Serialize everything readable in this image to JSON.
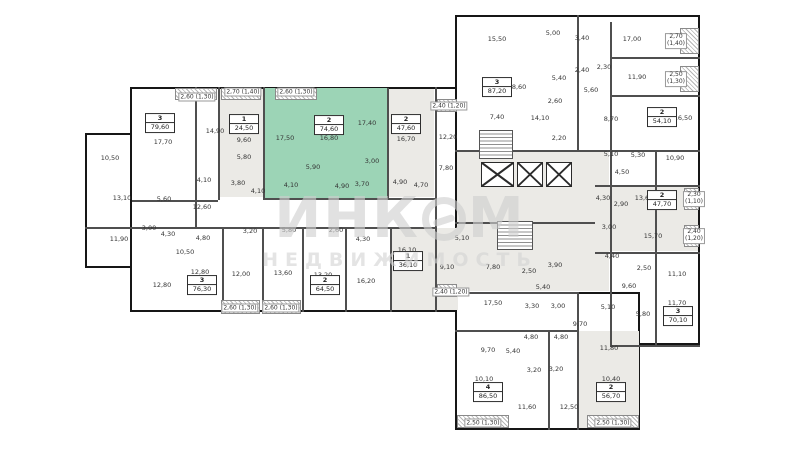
{
  "watermark": {
    "part1": "ИНК",
    "part2": "М",
    "subtitle": "НЕДВИЖИМОСТЬ"
  },
  "palette": {
    "wall": "#161616",
    "partition": "#4f4f4f",
    "unit_gray": "#ebeae6",
    "highlight_green": "#9cd4b6",
    "label_color": "#343434",
    "watermark_gray": "#d0d0d0"
  },
  "plan": {
    "outer": [
      {
        "x": 85,
        "y": 133,
        "w": 47,
        "h": 135
      },
      {
        "x": 130,
        "y": 87,
        "w": 330,
        "h": 225
      },
      {
        "x": 455,
        "y": 15,
        "w": 245,
        "h": 330
      },
      {
        "x": 455,
        "y": 292,
        "w": 185,
        "h": 138
      }
    ],
    "fills": [
      {
        "x": 219,
        "y": 89,
        "w": 44,
        "h": 108,
        "c": "#ebeae6"
      },
      {
        "x": 388,
        "y": 89,
        "w": 46,
        "h": 108,
        "c": "#ebeae6"
      },
      {
        "x": 390,
        "y": 228,
        "w": 68,
        "h": 82,
        "c": "#ebeae6"
      },
      {
        "x": 457,
        "y": 151,
        "w": 152,
        "h": 140,
        "c": "#ebeae6"
      },
      {
        "x": 596,
        "y": 186,
        "w": 102,
        "h": 65,
        "c": "#ebeae6"
      },
      {
        "x": 578,
        "y": 331,
        "w": 61,
        "h": 97,
        "c": "#ebeae6"
      },
      {
        "x": 263,
        "y": 88,
        "w": 124,
        "h": 110,
        "c": "#9cd4b6",
        "highlight": true
      }
    ],
    "walls_v": [
      {
        "x": 195,
        "y": 87,
        "len": 140
      },
      {
        "x": 218,
        "y": 87,
        "len": 113
      },
      {
        "x": 263,
        "y": 87,
        "len": 111
      },
      {
        "x": 387,
        "y": 88,
        "len": 110
      },
      {
        "x": 435,
        "y": 87,
        "len": 225
      },
      {
        "x": 222,
        "y": 227,
        "len": 85
      },
      {
        "x": 262,
        "y": 227,
        "len": 85
      },
      {
        "x": 302,
        "y": 227,
        "len": 85
      },
      {
        "x": 345,
        "y": 227,
        "len": 85
      },
      {
        "x": 390,
        "y": 227,
        "len": 85
      },
      {
        "x": 577,
        "y": 15,
        "len": 135
      },
      {
        "x": 610,
        "y": 22,
        "len": 323
      },
      {
        "x": 655,
        "y": 150,
        "len": 195
      },
      {
        "x": 577,
        "y": 292,
        "len": 138
      },
      {
        "x": 548,
        "y": 330,
        "len": 100
      }
    ],
    "walls_h": [
      {
        "y": 198,
        "x": 263,
        "len": 172
      },
      {
        "y": 227,
        "x": 85,
        "len": 350
      },
      {
        "y": 200,
        "x": 132,
        "len": 86
      },
      {
        "y": 150,
        "x": 455,
        "len": 245
      },
      {
        "y": 95,
        "x": 610,
        "len": 90
      },
      {
        "y": 57,
        "x": 610,
        "len": 90
      },
      {
        "y": 185,
        "x": 595,
        "len": 105
      },
      {
        "y": 252,
        "x": 595,
        "len": 105
      },
      {
        "y": 222,
        "x": 455,
        "len": 140
      },
      {
        "y": 292,
        "x": 437,
        "len": 140
      },
      {
        "y": 345,
        "x": 610,
        "len": 90
      },
      {
        "y": 330,
        "x": 455,
        "len": 122
      }
    ],
    "hatches": [
      {
        "x": 175,
        "y": 88,
        "w": 42,
        "h": 12
      },
      {
        "x": 221,
        "y": 88,
        "w": 40,
        "h": 12
      },
      {
        "x": 275,
        "y": 88,
        "w": 42,
        "h": 12
      },
      {
        "x": 437,
        "y": 99,
        "w": 20,
        "h": 13
      },
      {
        "x": 221,
        "y": 300,
        "w": 39,
        "h": 14
      },
      {
        "x": 262,
        "y": 300,
        "w": 39,
        "h": 14
      },
      {
        "x": 437,
        "y": 284,
        "w": 20,
        "h": 13
      },
      {
        "x": 457,
        "y": 415,
        "w": 52,
        "h": 13
      },
      {
        "x": 587,
        "y": 415,
        "w": 52,
        "h": 13
      },
      {
        "x": 680,
        "y": 28,
        "w": 19,
        "h": 26
      },
      {
        "x": 680,
        "y": 66,
        "w": 19,
        "h": 26
      },
      {
        "x": 684,
        "y": 188,
        "w": 15,
        "h": 22
      },
      {
        "x": 684,
        "y": 225,
        "w": 15,
        "h": 22
      }
    ],
    "shafts": [
      {
        "x": 481,
        "y": 162,
        "w": 33,
        "h": 25
      },
      {
        "x": 517,
        "y": 162,
        "w": 26,
        "h": 25
      },
      {
        "x": 546,
        "y": 162,
        "w": 26,
        "h": 25
      }
    ],
    "stairs": [
      {
        "x": 479,
        "y": 130,
        "w": 34,
        "h": 29
      },
      {
        "x": 497,
        "y": 221,
        "w": 36,
        "h": 29
      }
    ],
    "badges": [
      {
        "num": "3",
        "area": "79,60",
        "x": 160,
        "y": 123
      },
      {
        "num": "1",
        "area": "24,50",
        "x": 244,
        "y": 124
      },
      {
        "num": "2",
        "area": "74,60",
        "x": 329,
        "y": 125,
        "hl": true
      },
      {
        "num": "2",
        "area": "47,60",
        "x": 406,
        "y": 124
      },
      {
        "num": "3",
        "area": "87,20",
        "x": 497,
        "y": 87
      },
      {
        "num": "2",
        "area": "54,10",
        "x": 662,
        "y": 117
      },
      {
        "num": "2",
        "area": "47,70",
        "x": 662,
        "y": 200
      },
      {
        "num": "3",
        "area": "70,10",
        "x": 678,
        "y": 316
      },
      {
        "num": "2",
        "area": "56,70",
        "x": 611,
        "y": 392
      },
      {
        "num": "4",
        "area": "86,50",
        "x": 488,
        "y": 392
      },
      {
        "num": "3",
        "area": "76,30",
        "x": 202,
        "y": 285
      },
      {
        "num": "2",
        "area": "64,50",
        "x": 325,
        "y": 285
      },
      {
        "num": "1",
        "area": "36,10",
        "x": 408,
        "y": 261
      }
    ],
    "room_labels": [
      {
        "t": "10,50",
        "x": 110,
        "y": 158
      },
      {
        "t": "13,10",
        "x": 122,
        "y": 198
      },
      {
        "t": "17,70",
        "x": 163,
        "y": 142
      },
      {
        "t": "14,90",
        "x": 215,
        "y": 131
      },
      {
        "t": "5,60",
        "x": 164,
        "y": 199
      },
      {
        "t": "4,10",
        "x": 204,
        "y": 180
      },
      {
        "t": "12,60",
        "x": 202,
        "y": 207
      },
      {
        "t": "11,90",
        "x": 119,
        "y": 239
      },
      {
        "t": "3,00",
        "x": 149,
        "y": 228
      },
      {
        "t": "4,30",
        "x": 168,
        "y": 234
      },
      {
        "t": "4,80",
        "x": 203,
        "y": 238
      },
      {
        "t": "9,60",
        "x": 244,
        "y": 140
      },
      {
        "t": "5,80",
        "x": 244,
        "y": 157
      },
      {
        "t": "3,80",
        "x": 238,
        "y": 183
      },
      {
        "t": "4,10",
        "x": 258,
        "y": 191
      },
      {
        "t": "17,50",
        "x": 285,
        "y": 138
      },
      {
        "t": "16,80",
        "x": 329,
        "y": 138
      },
      {
        "t": "17,40",
        "x": 367,
        "y": 123
      },
      {
        "t": "5,90",
        "x": 313,
        "y": 167
      },
      {
        "t": "3,00",
        "x": 372,
        "y": 161
      },
      {
        "t": "4,10",
        "x": 291,
        "y": 185
      },
      {
        "t": "4,90",
        "x": 342,
        "y": 186
      },
      {
        "t": "3,70",
        "x": 362,
        "y": 184
      },
      {
        "t": "16,70",
        "x": 406,
        "y": 139
      },
      {
        "t": "4,90",
        "x": 400,
        "y": 182
      },
      {
        "t": "4,70",
        "x": 421,
        "y": 185
      },
      {
        "t": "10,50",
        "x": 185,
        "y": 252
      },
      {
        "t": "3,20",
        "x": 250,
        "y": 231
      },
      {
        "t": "5,80",
        "x": 289,
        "y": 230
      },
      {
        "t": "2,60",
        "x": 336,
        "y": 230
      },
      {
        "t": "4,30",
        "x": 363,
        "y": 239
      },
      {
        "t": "12,80",
        "x": 162,
        "y": 285
      },
      {
        "t": "12,80",
        "x": 200,
        "y": 272
      },
      {
        "t": "12,00",
        "x": 241,
        "y": 274
      },
      {
        "t": "13,60",
        "x": 283,
        "y": 273
      },
      {
        "t": "13,20",
        "x": 323,
        "y": 275
      },
      {
        "t": "16,20",
        "x": 366,
        "y": 281
      },
      {
        "t": "16,10",
        "x": 407,
        "y": 250
      },
      {
        "t": "9,10",
        "x": 447,
        "y": 267
      },
      {
        "t": "5,10",
        "x": 462,
        "y": 238
      },
      {
        "t": "12,20",
        "x": 448,
        "y": 137
      },
      {
        "t": "7,80",
        "x": 446,
        "y": 168
      },
      {
        "t": "7,80",
        "x": 493,
        "y": 267
      },
      {
        "t": "2,50",
        "x": 529,
        "y": 271
      },
      {
        "t": "3,90",
        "x": 555,
        "y": 265
      },
      {
        "t": "5,40",
        "x": 543,
        "y": 287
      },
      {
        "t": "2,20",
        "x": 559,
        "y": 138
      },
      {
        "t": "15,50",
        "x": 497,
        "y": 39
      },
      {
        "t": "5,00",
        "x": 553,
        "y": 33
      },
      {
        "t": "3,40",
        "x": 582,
        "y": 38
      },
      {
        "t": "18,60",
        "x": 517,
        "y": 87
      },
      {
        "t": "2,40",
        "x": 582,
        "y": 70
      },
      {
        "t": "2,30",
        "x": 604,
        "y": 67
      },
      {
        "t": "5,40",
        "x": 559,
        "y": 78
      },
      {
        "t": "5,60",
        "x": 591,
        "y": 90
      },
      {
        "t": "2,60",
        "x": 555,
        "y": 101
      },
      {
        "t": "7,40",
        "x": 497,
        "y": 117
      },
      {
        "t": "14,10",
        "x": 540,
        "y": 118
      },
      {
        "t": "17,00",
        "x": 632,
        "y": 39
      },
      {
        "t": "11,90",
        "x": 637,
        "y": 77
      },
      {
        "t": "8,70",
        "x": 611,
        "y": 119
      },
      {
        "t": "16,50",
        "x": 683,
        "y": 118
      },
      {
        "t": "5,10",
        "x": 611,
        "y": 154
      },
      {
        "t": "5,30",
        "x": 638,
        "y": 155
      },
      {
        "t": "10,90",
        "x": 675,
        "y": 158
      },
      {
        "t": "4,50",
        "x": 622,
        "y": 172
      },
      {
        "t": "4,30",
        "x": 603,
        "y": 198
      },
      {
        "t": "2,90",
        "x": 621,
        "y": 204
      },
      {
        "t": "13,60",
        "x": 644,
        "y": 198
      },
      {
        "t": "3,00",
        "x": 609,
        "y": 227
      },
      {
        "t": "15,70",
        "x": 653,
        "y": 236
      },
      {
        "t": "4,40",
        "x": 612,
        "y": 256
      },
      {
        "t": "2,50",
        "x": 644,
        "y": 268
      },
      {
        "t": "11,10",
        "x": 677,
        "y": 274
      },
      {
        "t": "9,60",
        "x": 629,
        "y": 286
      },
      {
        "t": "5,10",
        "x": 608,
        "y": 307
      },
      {
        "t": "5,80",
        "x": 643,
        "y": 314
      },
      {
        "t": "11,70",
        "x": 677,
        "y": 303
      },
      {
        "t": "17,50",
        "x": 493,
        "y": 303
      },
      {
        "t": "3,30",
        "x": 532,
        "y": 306
      },
      {
        "t": "3,00",
        "x": 558,
        "y": 306
      },
      {
        "t": "9,70",
        "x": 580,
        "y": 324
      },
      {
        "t": "4,80",
        "x": 531,
        "y": 337
      },
      {
        "t": "4,80",
        "x": 561,
        "y": 337
      },
      {
        "t": "5,40",
        "x": 513,
        "y": 351
      },
      {
        "t": "9,70",
        "x": 488,
        "y": 350
      },
      {
        "t": "11,80",
        "x": 609,
        "y": 348
      },
      {
        "t": "3,20",
        "x": 534,
        "y": 370
      },
      {
        "t": "3,20",
        "x": 556,
        "y": 369
      },
      {
        "t": "10,10",
        "x": 484,
        "y": 379
      },
      {
        "t": "10,40",
        "x": 611,
        "y": 379
      },
      {
        "t": "11,60",
        "x": 527,
        "y": 407
      },
      {
        "t": "12,50",
        "x": 569,
        "y": 407
      }
    ],
    "balcony_labels": [
      {
        "t": "2,60 (1,30)",
        "x": 197,
        "y": 97
      },
      {
        "t": "2,70 (1,40)",
        "x": 243,
        "y": 92
      },
      {
        "t": "2,60 (1,30)",
        "x": 296,
        "y": 92
      },
      {
        "t": "2,40 (1,20)",
        "x": 449,
        "y": 106
      },
      {
        "t": "2,60 (1,30)",
        "x": 240,
        "y": 308
      },
      {
        "t": "2,60 (1,30)",
        "x": 281,
        "y": 308
      },
      {
        "t": "2,40 (1,20)",
        "x": 451,
        "y": 292
      },
      {
        "t": "2,50 (1,30)",
        "x": 483,
        "y": 423
      },
      {
        "t": "2,50 (1,30)",
        "x": 613,
        "y": 423
      }
    ],
    "stacked_labels": [
      {
        "l1": "2,70",
        "l2": "(1,40)",
        "x": 676,
        "y": 41
      },
      {
        "l1": "2,50",
        "l2": "(1,30)",
        "x": 676,
        "y": 79
      },
      {
        "l1": "2,30",
        "l2": "(1,10)",
        "x": 694,
        "y": 199
      },
      {
        "l1": "2,40",
        "l2": "(1,20)",
        "x": 694,
        "y": 236
      }
    ]
  }
}
